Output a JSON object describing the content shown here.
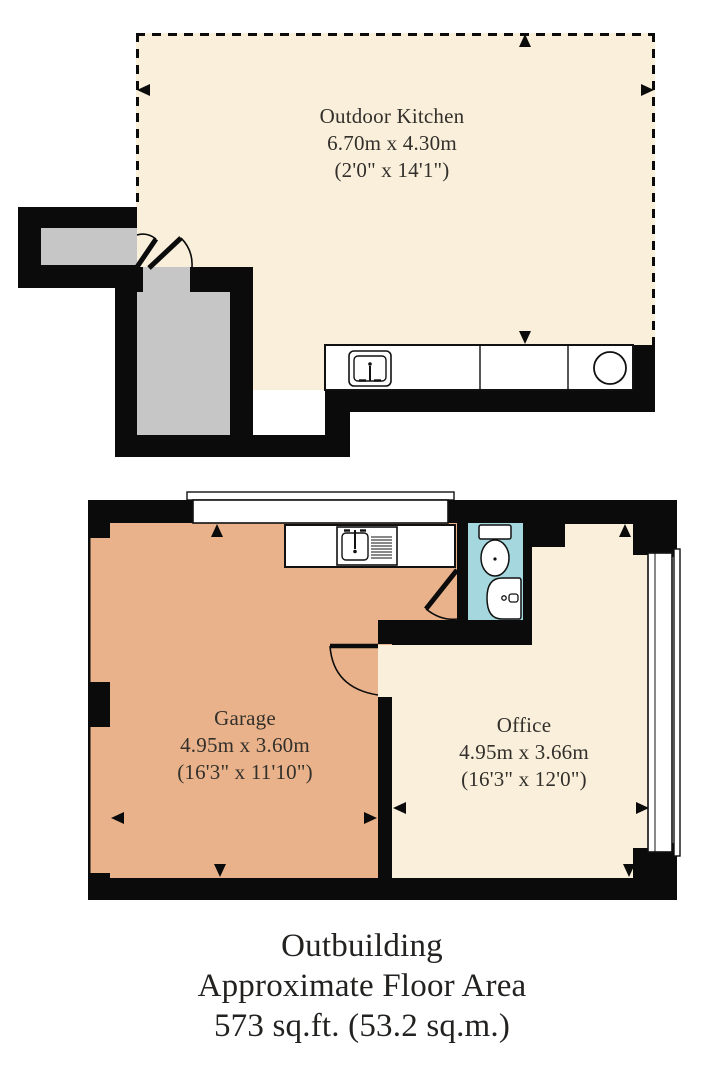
{
  "plan_title": "Outbuilding floor plan",
  "rooms": {
    "outdoor_kitchen": {
      "name": "Outdoor Kitchen",
      "metric": "6.70m x 4.30m",
      "imperial": "(2'0\" x 14'1\")"
    },
    "garage": {
      "name": "Garage",
      "metric": "4.95m x 3.60m",
      "imperial": "(16'3\" x 11'10\")"
    },
    "office": {
      "name": "Office",
      "metric": "4.95m x 3.66m",
      "imperial": "(16'3\" x 12'0\")"
    }
  },
  "caption": {
    "line1": "Outbuilding",
    "line2": "Approximate Floor Area",
    "line3": "573 sq.ft. (53.2 sq.m.)"
  },
  "fixtures": {
    "upper": [
      "sink-icon",
      "hob-icon"
    ],
    "lower": [
      "sink-drainer-icon",
      "toilet-icon",
      "basin-icon"
    ]
  },
  "colors": {
    "floor_cream": "#f9efdb",
    "floor_orange": "#e9b28a",
    "floor_cyan": "#a4d8de",
    "interior_gray": "#c6c6c6",
    "wall_black": "#0b0b0b",
    "fixture_white": "#ffffff",
    "text": "#2b2723"
  }
}
